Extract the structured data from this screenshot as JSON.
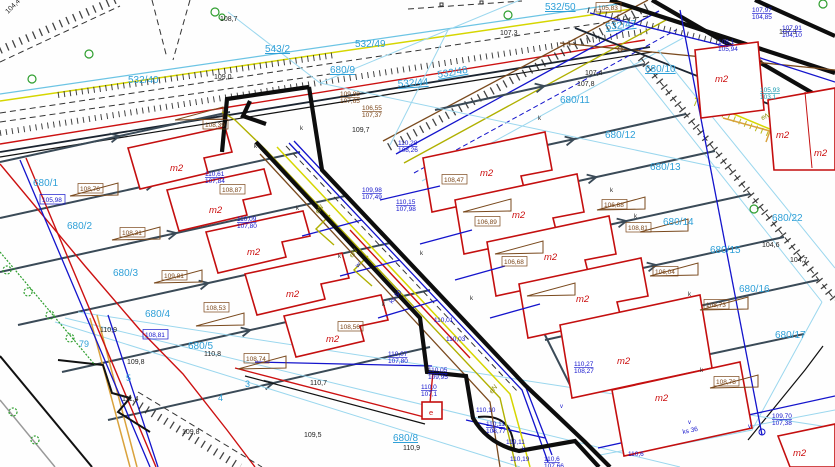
{
  "map_title": "cadastral-survey-map",
  "colors": {
    "parcel_text": "#2fa0d8",
    "building": "#c40f0f",
    "boundary": "#0d0d0d",
    "utility_blue": "#1414cc",
    "utility_yellow": "#d6d600",
    "utility_brown": "#7a4a1e",
    "slate_boundary": "#3a4a57",
    "water_red": "#cc1111",
    "tree_green": "#2e9e2e"
  },
  "map_labels": [
    {
      "t": "532/40",
      "x": 128,
      "y": 83,
      "cls": "p"
    },
    {
      "t": "532/49",
      "x": 355,
      "y": 47,
      "cls": "p"
    },
    {
      "t": "532/44",
      "x": 398,
      "y": 87,
      "cls": "pu",
      "r": -4
    },
    {
      "t": "532/48",
      "x": 438,
      "y": 78,
      "cls": "pu",
      "r": -10
    },
    {
      "t": "532/47",
      "x": 606,
      "y": 30,
      "cls": "pu",
      "r": -6
    },
    {
      "t": "532/50",
      "x": 545,
      "y": 10,
      "cls": "pu"
    },
    {
      "t": "543/2",
      "x": 265,
      "y": 52,
      "cls": "pu"
    },
    {
      "t": "680/9",
      "x": 330,
      "y": 73,
      "cls": "pu"
    },
    {
      "t": "680/10",
      "x": 645,
      "y": 72,
      "cls": "pu"
    },
    {
      "t": "680/11",
      "x": 560,
      "y": 103,
      "cls": "p"
    },
    {
      "t": "680/12",
      "x": 605,
      "y": 138,
      "cls": "p"
    },
    {
      "t": "680/13",
      "x": 650,
      "y": 170,
      "cls": "p"
    },
    {
      "t": "680/14",
      "x": 663,
      "y": 225,
      "cls": "p"
    },
    {
      "t": "680/15",
      "x": 710,
      "y": 253,
      "cls": "p"
    },
    {
      "t": "680/16",
      "x": 739,
      "y": 292,
      "cls": "p"
    },
    {
      "t": "680/22",
      "x": 772,
      "y": 221,
      "cls": "p"
    },
    {
      "t": "680/17",
      "x": 775,
      "y": 338,
      "cls": "p"
    },
    {
      "t": "680/8",
      "x": 393,
      "y": 441,
      "cls": "pu"
    },
    {
      "t": "680/1",
      "x": 33,
      "y": 186,
      "cls": "p"
    },
    {
      "t": "680/2",
      "x": 67,
      "y": 229,
      "cls": "p"
    },
    {
      "t": "680/3",
      "x": 113,
      "y": 276,
      "cls": "p"
    },
    {
      "t": "680/4",
      "x": 145,
      "y": 317,
      "cls": "p"
    },
    {
      "t": "680/5",
      "x": 188,
      "y": 349,
      "cls": "p"
    },
    {
      "t": "79",
      "x": 79,
      "y": 347,
      "cls": "pd"
    },
    {
      "t": "5",
      "x": 126,
      "y": 381,
      "cls": "pd"
    },
    {
      "t": "4",
      "x": 218,
      "y": 401,
      "cls": "pd"
    },
    {
      "t": "3",
      "x": 245,
      "y": 387,
      "cls": "pd"
    },
    {
      "t": "m2",
      "x": 170,
      "y": 171,
      "cls": "b"
    },
    {
      "t": "m2",
      "x": 209,
      "y": 213,
      "cls": "b"
    },
    {
      "t": "m2",
      "x": 247,
      "y": 255,
      "cls": "b"
    },
    {
      "t": "m2",
      "x": 286,
      "y": 297,
      "cls": "b"
    },
    {
      "t": "m2",
      "x": 326,
      "y": 342,
      "cls": "b"
    },
    {
      "t": "m2",
      "x": 480,
      "y": 176,
      "cls": "b"
    },
    {
      "t": "m2",
      "x": 512,
      "y": 218,
      "cls": "b"
    },
    {
      "t": "m2",
      "x": 544,
      "y": 260,
      "cls": "b"
    },
    {
      "t": "m2",
      "x": 576,
      "y": 302,
      "cls": "b"
    },
    {
      "t": "m2",
      "x": 617,
      "y": 364,
      "cls": "b"
    },
    {
      "t": "m2",
      "x": 655,
      "y": 401,
      "cls": "b"
    },
    {
      "t": "m2",
      "x": 715,
      "y": 82,
      "cls": "b"
    },
    {
      "t": "m2",
      "x": 776,
      "y": 138,
      "cls": "b"
    },
    {
      "t": "m2",
      "x": 814,
      "y": 156,
      "cls": "b"
    },
    {
      "t": "m2",
      "x": 793,
      "y": 456,
      "cls": "b"
    },
    {
      "t": "108,76",
      "x": 80,
      "y": 191,
      "cls": "rb",
      "bx": 1
    },
    {
      "t": "108,31",
      "x": 122,
      "y": 235,
      "cls": "rb",
      "bx": 1
    },
    {
      "t": "109,81",
      "x": 164,
      "y": 278,
      "cls": "rb",
      "bx": 1
    },
    {
      "t": "108,39",
      "x": 205,
      "y": 127,
      "cls": "rb",
      "bx": 1
    },
    {
      "t": "108,87",
      "x": 222,
      "y": 192,
      "cls": "rb",
      "bx": 1
    },
    {
      "t": "108,53",
      "x": 206,
      "y": 310,
      "cls": "rb",
      "bx": 1
    },
    {
      "t": "108,56",
      "x": 340,
      "y": 329,
      "cls": "rb",
      "bx": 1
    },
    {
      "t": "108,74",
      "x": 246,
      "y": 361,
      "cls": "rb",
      "bx": 1
    },
    {
      "t": "106,89",
      "x": 477,
      "y": 224,
      "cls": "rb",
      "bx": 1
    },
    {
      "t": "106,68",
      "x": 504,
      "y": 264,
      "cls": "rb",
      "bx": 1
    },
    {
      "t": "108,47",
      "x": 444,
      "y": 182,
      "cls": "rb",
      "bx": 1
    },
    {
      "t": "106,88",
      "x": 604,
      "y": 207,
      "cls": "rb",
      "bx": 1
    },
    {
      "t": "108,81",
      "x": 628,
      "y": 230,
      "cls": "rb",
      "bx": 1
    },
    {
      "t": "106,04",
      "x": 655,
      "y": 274,
      "cls": "rb",
      "bx": 1
    },
    {
      "t": "108,73",
      "x": 706,
      "y": 307,
      "cls": "rb",
      "bx": 1
    },
    {
      "t": "108,78",
      "x": 716,
      "y": 384,
      "cls": "rb",
      "bx": 1
    },
    {
      "t": "105,83",
      "x": 598,
      "y": 10,
      "cls": "rb",
      "bx": 1
    },
    {
      "t": "109,88/107,65",
      "x": 340,
      "y": 96,
      "cls": "brp",
      "sp": 1
    },
    {
      "t": "106,55/107,37",
      "x": 362,
      "y": 110,
      "cls": "brp",
      "sp": 1
    },
    {
      "t": "109,0",
      "x": 214,
      "y": 79,
      "cls": "s"
    },
    {
      "t": "108,7",
      "x": 220,
      "y": 21,
      "cls": "s"
    },
    {
      "t": "107,3",
      "x": 500,
      "y": 35,
      "cls": "s"
    },
    {
      "t": "107,3",
      "x": 779,
      "y": 34,
      "cls": "s"
    },
    {
      "t": "107,4",
      "x": 585,
      "y": 75,
      "cls": "s"
    },
    {
      "t": "107,8",
      "x": 577,
      "y": 86,
      "cls": "s"
    },
    {
      "t": "110,9",
      "x": 100,
      "y": 332,
      "cls": "s"
    },
    {
      "t": "110,8",
      "x": 204,
      "y": 356,
      "cls": "s"
    },
    {
      "t": "109,8",
      "x": 127,
      "y": 364,
      "cls": "s"
    },
    {
      "t": "111,4",
      "x": 122,
      "y": 401,
      "cls": "s"
    },
    {
      "t": "109,8",
      "x": 182,
      "y": 434,
      "cls": "s"
    },
    {
      "t": "109,5",
      "x": 304,
      "y": 437,
      "cls": "s"
    },
    {
      "t": "109,7",
      "x": 352,
      "y": 132,
      "cls": "s"
    },
    {
      "t": "110,9",
      "x": 403,
      "y": 450,
      "cls": "s"
    },
    {
      "t": "110,7",
      "x": 310,
      "y": 385,
      "cls": "s"
    },
    {
      "t": "104,4",
      "x": 8,
      "y": 14,
      "cls": "s",
      "r": -45
    },
    {
      "t": "104,6",
      "x": 762,
      "y": 247,
      "cls": "s"
    },
    {
      "t": "104,7",
      "x": 790,
      "y": 262,
      "cls": "s"
    },
    {
      "t": "110,15/107,98",
      "x": 396,
      "y": 204,
      "cls": "ub",
      "sp": 1
    },
    {
      "t": "109,98/107,49",
      "x": 362,
      "y": 192,
      "cls": "ub",
      "sp": 1
    },
    {
      "t": "110,28/108,26",
      "x": 398,
      "y": 145,
      "cls": "ub",
      "sp": 1
    },
    {
      "t": "110,07/107,80",
      "x": 388,
      "y": 356,
      "cls": "ub",
      "sp": 1
    },
    {
      "t": "110,05/109,95",
      "x": 428,
      "y": 372,
      "cls": "ub",
      "sp": 1
    },
    {
      "t": "110,10",
      "x": 476,
      "y": 412,
      "cls": "ub"
    },
    {
      "t": "110,11/108,77",
      "x": 486,
      "y": 426,
      "cls": "ub",
      "sp": 1
    },
    {
      "t": "110,11",
      "x": 506,
      "y": 444,
      "cls": "ub"
    },
    {
      "t": "110,19",
      "x": 510,
      "y": 461,
      "cls": "ub"
    },
    {
      "t": "110,0/107,1",
      "x": 421,
      "y": 389,
      "cls": "ub",
      "sp": 1
    },
    {
      "t": "110,6/107,66",
      "x": 544,
      "y": 461,
      "cls": "ub",
      "sp": 1
    },
    {
      "t": "110,6",
      "x": 628,
      "y": 456,
      "cls": "ub"
    },
    {
      "t": "109,70/107,38",
      "x": 772,
      "y": 418,
      "cls": "ub",
      "sp": 1
    },
    {
      "t": "107,97/104,85",
      "x": 752,
      "y": 12,
      "cls": "ub",
      "sp": 1
    },
    {
      "t": "107,91/104,10",
      "x": 782,
      "y": 30,
      "cls": "ub",
      "sp": 1
    },
    {
      "t": "108,1/105,94",
      "x": 718,
      "y": 44,
      "cls": "ub",
      "sp": 1
    },
    {
      "t": "110,27/108,27",
      "x": 574,
      "y": 366,
      "cls": "ub",
      "sp": 1
    },
    {
      "t": "110,01",
      "x": 434,
      "y": 322,
      "cls": "ub"
    },
    {
      "t": "110,03",
      "x": 446,
      "y": 341,
      "cls": "ub"
    },
    {
      "t": "110,61/107,84",
      "x": 205,
      "y": 176,
      "cls": "ub",
      "sp": 1
    },
    {
      "t": "110,09/107,80",
      "x": 237,
      "y": 221,
      "cls": "ub",
      "sp": 1
    },
    {
      "t": "105,98",
      "x": 42,
      "y": 202,
      "cls": "ubx",
      "bx": 1
    },
    {
      "t": "108,81",
      "x": 145,
      "y": 337,
      "cls": "ubx",
      "bx": 1
    },
    {
      "t": "105,93/103,1",
      "x": 760,
      "y": 92,
      "cls": "teal",
      "sp": 1
    },
    {
      "t": "eN",
      "x": 318,
      "y": 214,
      "cls": "y",
      "r": -50
    },
    {
      "t": "eN",
      "x": 352,
      "y": 258,
      "cls": "y",
      "r": -50
    },
    {
      "t": "eN",
      "x": 492,
      "y": 394,
      "cls": "y",
      "r": -50
    },
    {
      "t": "eN",
      "x": 762,
      "y": 120,
      "cls": "y",
      "r": -20
    },
    {
      "t": "ks 50",
      "x": 392,
      "y": 304,
      "cls": "ub",
      "r": -50
    },
    {
      "t": "ks 36",
      "x": 683,
      "y": 434,
      "cls": "ub",
      "r": -12
    },
    {
      "t": "w",
      "x": 358,
      "y": 268,
      "cls": "ub",
      "r": -50
    },
    {
      "t": "k",
      "x": 254,
      "y": 148,
      "cls": "k"
    },
    {
      "t": "k",
      "x": 296,
      "y": 210,
      "cls": "k"
    },
    {
      "t": "k",
      "x": 338,
      "y": 258,
      "cls": "k"
    },
    {
      "t": "k",
      "x": 382,
      "y": 306,
      "cls": "k"
    },
    {
      "t": "k",
      "x": 300,
      "y": 130,
      "cls": "k"
    },
    {
      "t": "k",
      "x": 420,
      "y": 255,
      "cls": "k"
    },
    {
      "t": "k",
      "x": 470,
      "y": 300,
      "cls": "k"
    },
    {
      "t": "k",
      "x": 610,
      "y": 192,
      "cls": "k"
    },
    {
      "t": "k",
      "x": 634,
      "y": 218,
      "cls": "k"
    },
    {
      "t": "k",
      "x": 688,
      "y": 296,
      "cls": "k"
    },
    {
      "t": "k",
      "x": 700,
      "y": 372,
      "cls": "k"
    },
    {
      "t": "k",
      "x": 538,
      "y": 120,
      "cls": "k"
    },
    {
      "t": "v",
      "x": 492,
      "y": 432,
      "cls": "kv"
    },
    {
      "t": "v",
      "x": 522,
      "y": 450,
      "cls": "kv"
    },
    {
      "t": "v",
      "x": 688,
      "y": 424,
      "cls": "kv"
    },
    {
      "t": "v",
      "x": 748,
      "y": 428,
      "cls": "kv"
    },
    {
      "t": "v",
      "x": 560,
      "y": 408,
      "cls": "kv"
    },
    {
      "t": "e",
      "x": 429,
      "y": 415,
      "cls": "re"
    }
  ]
}
